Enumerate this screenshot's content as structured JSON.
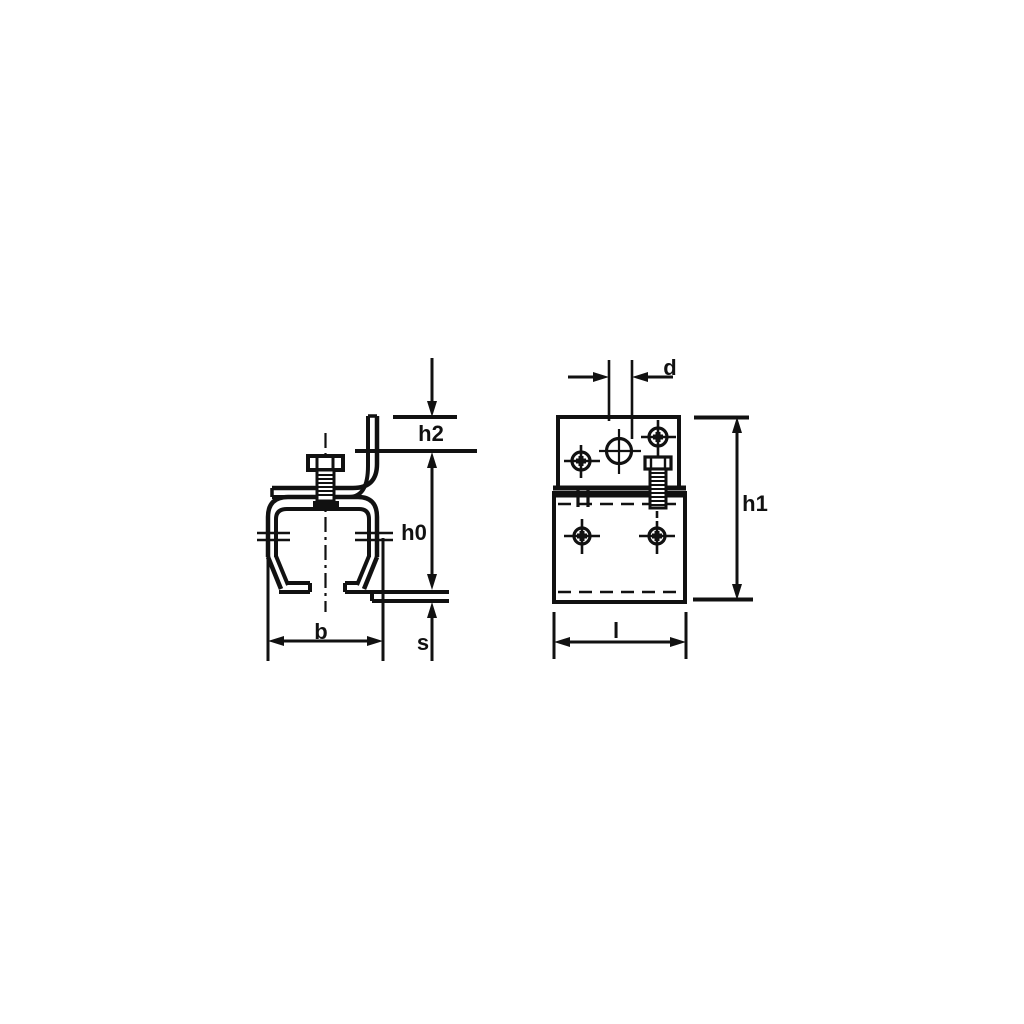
{
  "drawing": {
    "background_color": "#ffffff",
    "line_color": "#111111",
    "dimension_labels": {
      "h2": "h2",
      "h0": "h0",
      "b": "b",
      "s": "s",
      "d": "d",
      "h1": "h1",
      "l": "l"
    }
  }
}
